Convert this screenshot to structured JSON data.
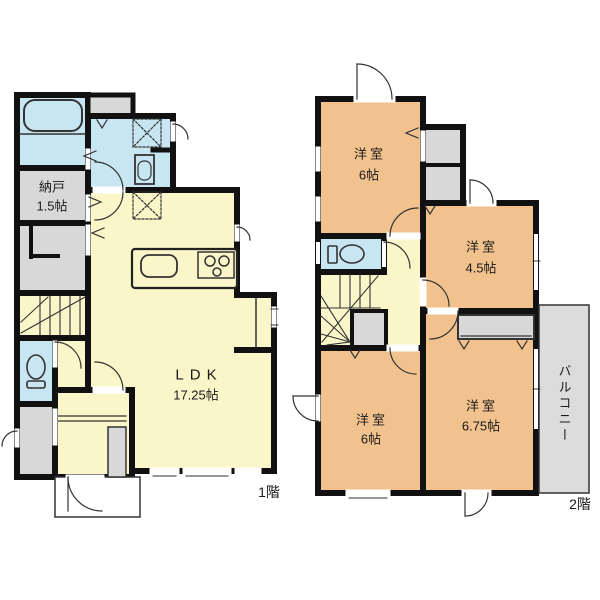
{
  "page": {
    "background": "#ffffff"
  },
  "colors": {
    "wall": "#111111",
    "living": "#FAF6C9",
    "bedroom": "#F1C28E",
    "water": "#C7E6F2",
    "closet": "#D8D8D8",
    "balcony": "#DCDCDC",
    "porch": "#FFFFFF"
  },
  "floor1": {
    "label": "1階",
    "rooms": {
      "nando": {
        "name": "納戸",
        "size": "1.5帖"
      },
      "ldk": {
        "name": "LDK",
        "size": "17.25帖"
      }
    }
  },
  "floor2": {
    "label": "2階",
    "rooms": {
      "bedroom_top": {
        "name": "洋室",
        "size": "6帖"
      },
      "bedroom_right": {
        "name": "洋室",
        "size": "4.5帖"
      },
      "bedroom_bottom_left": {
        "name": "洋室",
        "size": "6帖"
      },
      "bedroom_bottom_right": {
        "name": "洋室",
        "size": "6.75帖"
      },
      "balcony": {
        "name": "バルコニー"
      }
    }
  }
}
